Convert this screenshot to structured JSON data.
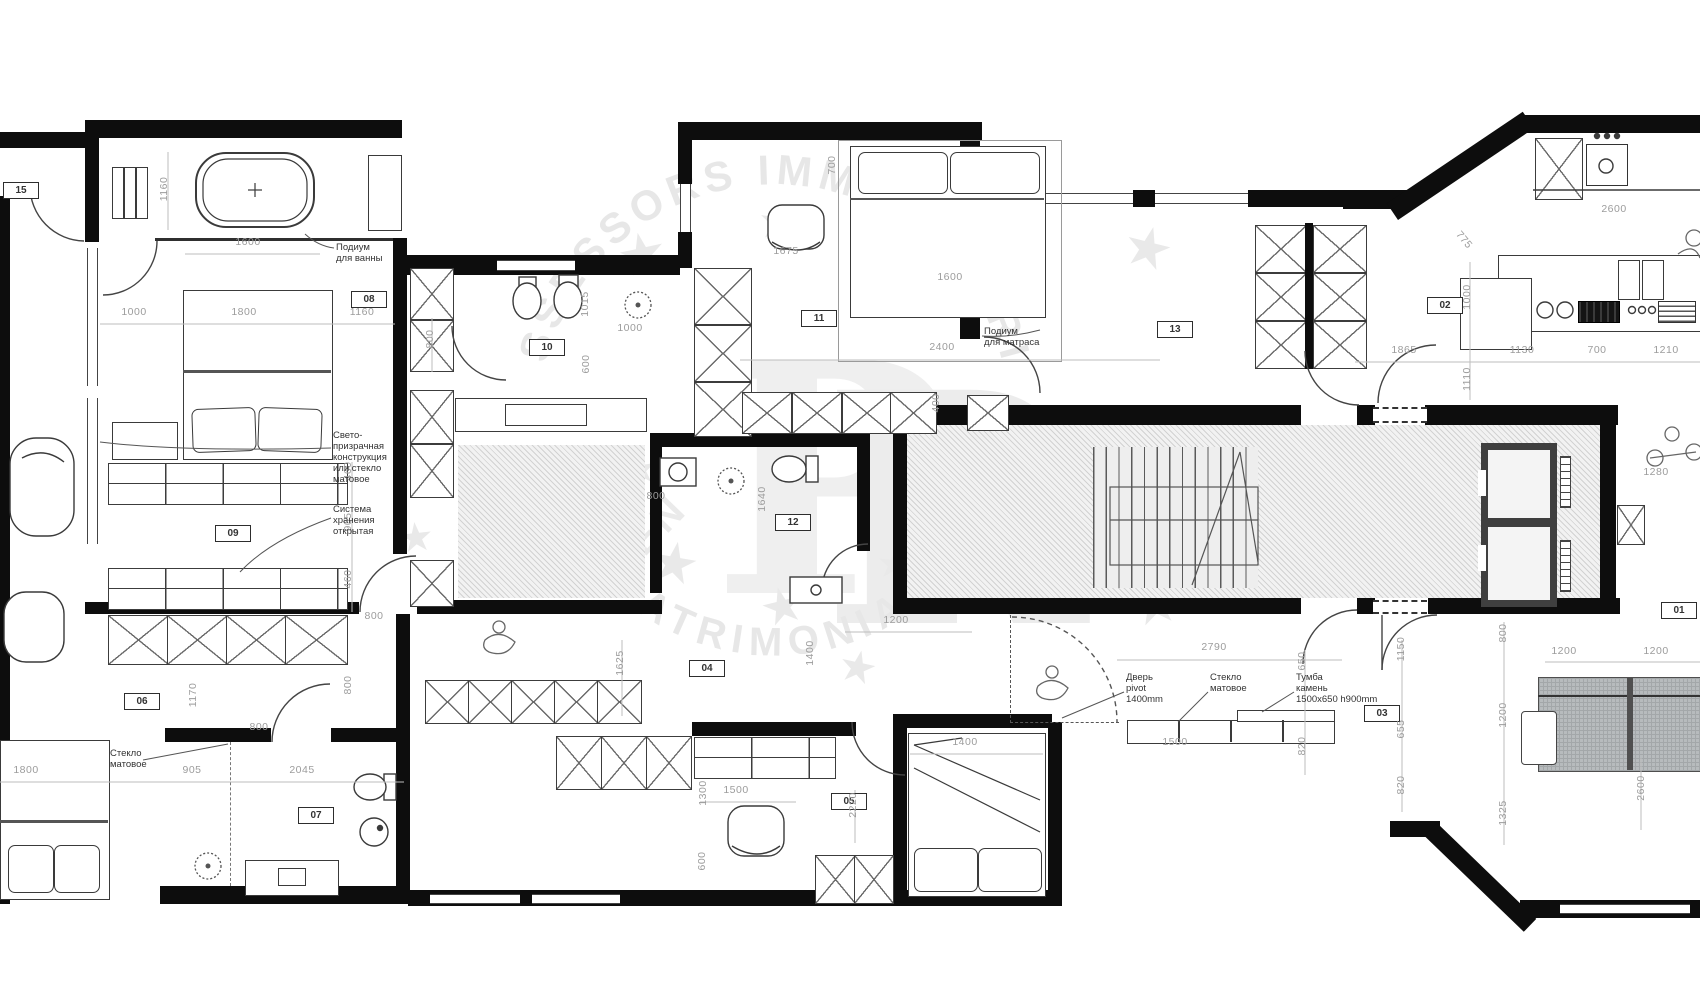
{
  "watermark": {
    "arc_top": "ASSESSORS IMMOBILIARIS",
    "arc_bottom": "PATRIMONIAL",
    "fragment": "MEN",
    "monogram_left": "P",
    "monogram_right": "R"
  },
  "rooms": [
    {
      "label": "15",
      "x": 20,
      "y": 190
    },
    {
      "label": "08",
      "x": 368,
      "y": 299
    },
    {
      "label": "09",
      "x": 232,
      "y": 533
    },
    {
      "label": "10",
      "x": 546,
      "y": 347
    },
    {
      "label": "11",
      "x": 818,
      "y": 318
    },
    {
      "label": "12",
      "x": 792,
      "y": 522
    },
    {
      "label": "13",
      "x": 1174,
      "y": 329
    },
    {
      "label": "02",
      "x": 1444,
      "y": 305
    },
    {
      "label": "01",
      "x": 1678,
      "y": 610
    },
    {
      "label": "03",
      "x": 1381,
      "y": 713
    },
    {
      "label": "04",
      "x": 706,
      "y": 668
    },
    {
      "label": "05",
      "x": 848,
      "y": 801
    },
    {
      "label": "06",
      "x": 141,
      "y": 701
    },
    {
      "label": "07",
      "x": 315,
      "y": 815
    }
  ],
  "dims": [
    {
      "t": "1160",
      "x": 164,
      "y": 190,
      "r": -90
    },
    {
      "t": "1600",
      "x": 248,
      "y": 243,
      "r": 0
    },
    {
      "t": "1000",
      "x": 134,
      "y": 313,
      "r": 0
    },
    {
      "t": "1800",
      "x": 244,
      "y": 313,
      "r": 0
    },
    {
      "t": "1160",
      "x": 362,
      "y": 313,
      "r": 0
    },
    {
      "t": "800",
      "x": 430,
      "y": 340,
      "r": -90
    },
    {
      "t": "460",
      "x": 348,
      "y": 472,
      "r": -90
    },
    {
      "t": "905",
      "x": 348,
      "y": 523,
      "r": -90
    },
    {
      "t": "460",
      "x": 348,
      "y": 580,
      "r": -90
    },
    {
      "t": "800",
      "x": 374,
      "y": 617,
      "r": 0
    },
    {
      "t": "700",
      "x": 832,
      "y": 166,
      "r": -90
    },
    {
      "t": "1675",
      "x": 786,
      "y": 252,
      "r": 0
    },
    {
      "t": "1600",
      "x": 950,
      "y": 278,
      "r": 0
    },
    {
      "t": "2400",
      "x": 942,
      "y": 348,
      "r": 0
    },
    {
      "t": "1000",
      "x": 630,
      "y": 329,
      "r": 0
    },
    {
      "t": "1015",
      "x": 585,
      "y": 305,
      "r": -90
    },
    {
      "t": "600",
      "x": 586,
      "y": 365,
      "r": -90
    },
    {
      "t": "800",
      "x": 656,
      "y": 497,
      "r": 0
    },
    {
      "t": "1640",
      "x": 762,
      "y": 500,
      "r": -90
    },
    {
      "t": "400",
      "x": 936,
      "y": 404,
      "r": -90
    },
    {
      "t": "2600",
      "x": 1614,
      "y": 210,
      "r": 0
    },
    {
      "t": "775",
      "x": 1464,
      "y": 241,
      "r": 50
    },
    {
      "t": "1000",
      "x": 1467,
      "y": 298,
      "r": -90
    },
    {
      "t": "1110",
      "x": 1467,
      "y": 380,
      "r": -90
    },
    {
      "t": "1865",
      "x": 1404,
      "y": 351,
      "r": 0
    },
    {
      "t": "1130",
      "x": 1522,
      "y": 351,
      "r": 0
    },
    {
      "t": "700",
      "x": 1597,
      "y": 351,
      "r": 0
    },
    {
      "t": "1210",
      "x": 1666,
      "y": 351,
      "r": 0
    },
    {
      "t": "1280",
      "x": 1656,
      "y": 473,
      "r": 0
    },
    {
      "t": "1200",
      "x": 896,
      "y": 621,
      "r": 0
    },
    {
      "t": "1625",
      "x": 620,
      "y": 664,
      "r": -90
    },
    {
      "t": "1400",
      "x": 810,
      "y": 654,
      "r": -90
    },
    {
      "t": "1400",
      "x": 965,
      "y": 743,
      "r": 0
    },
    {
      "t": "1500",
      "x": 736,
      "y": 791,
      "r": 0
    },
    {
      "t": "1300",
      "x": 703,
      "y": 794,
      "r": -90
    },
    {
      "t": "2220",
      "x": 853,
      "y": 806,
      "r": -90
    },
    {
      "t": "600",
      "x": 702,
      "y": 862,
      "r": -90
    },
    {
      "t": "1170",
      "x": 193,
      "y": 696,
      "r": -90
    },
    {
      "t": "800",
      "x": 259,
      "y": 728,
      "r": 0
    },
    {
      "t": "800",
      "x": 348,
      "y": 686,
      "r": -90
    },
    {
      "t": "1800",
      "x": 26,
      "y": 771,
      "r": 0
    },
    {
      "t": "905",
      "x": 192,
      "y": 771,
      "r": 0
    },
    {
      "t": "2045",
      "x": 302,
      "y": 771,
      "r": 0
    },
    {
      "t": "2790",
      "x": 1214,
      "y": 648,
      "r": 0
    },
    {
      "t": "1500",
      "x": 1175,
      "y": 743,
      "r": 0
    },
    {
      "t": "650",
      "x": 1302,
      "y": 662,
      "r": -90
    },
    {
      "t": "820",
      "x": 1302,
      "y": 747,
      "r": -90
    },
    {
      "t": "1150",
      "x": 1401,
      "y": 650,
      "r": -90
    },
    {
      "t": "655",
      "x": 1401,
      "y": 730,
      "r": -90
    },
    {
      "t": "820",
      "x": 1401,
      "y": 786,
      "r": -90
    },
    {
      "t": "800",
      "x": 1503,
      "y": 634,
      "r": -90
    },
    {
      "t": "1200",
      "x": 1564,
      "y": 652,
      "r": 0
    },
    {
      "t": "1200",
      "x": 1656,
      "y": 652,
      "r": 0
    },
    {
      "t": "1200",
      "x": 1503,
      "y": 716,
      "r": -90
    },
    {
      "t": "1325",
      "x": 1503,
      "y": 814,
      "r": -90
    },
    {
      "t": "2600",
      "x": 1641,
      "y": 789,
      "r": -90
    }
  ],
  "annotations": [
    {
      "text": "Подиум\nдля ванны",
      "x": 336,
      "y": 242
    },
    {
      "text": "Свето-\nпризрачная\nконструкция\nили стекло\nматовое",
      "x": 333,
      "y": 430
    },
    {
      "text": "Система\nхранения\nоткрытая",
      "x": 333,
      "y": 504
    },
    {
      "text": "Подиум\nдля матраса",
      "x": 984,
      "y": 326
    },
    {
      "text": "Дверь\npivot\n1400mm",
      "x": 1126,
      "y": 672
    },
    {
      "text": "Стекло\nматовое",
      "x": 1210,
      "y": 672
    },
    {
      "text": "Тумба\nкамень\n1500x650  h900mm",
      "x": 1296,
      "y": 672
    },
    {
      "text": "Стекло\nматовое",
      "x": 110,
      "y": 748
    }
  ],
  "stars": [
    {
      "t": "★",
      "x": 617,
      "y": 226,
      "s": 56,
      "r": -12
    },
    {
      "t": "★",
      "x": 757,
      "y": 200,
      "s": 48,
      "r": 8
    },
    {
      "t": "★",
      "x": 944,
      "y": 192,
      "s": 52,
      "r": -6
    },
    {
      "t": "★",
      "x": 1123,
      "y": 220,
      "s": 56,
      "r": 14
    },
    {
      "t": "★",
      "x": 874,
      "y": 282,
      "s": 34,
      "r": 0
    },
    {
      "t": "★",
      "x": 622,
      "y": 450,
      "s": 40,
      "r": -8
    },
    {
      "t": "★",
      "x": 649,
      "y": 535,
      "s": 56,
      "r": 10
    },
    {
      "t": "★",
      "x": 760,
      "y": 581,
      "s": 50,
      "r": -14
    },
    {
      "t": "★",
      "x": 876,
      "y": 545,
      "s": 40,
      "r": 6
    },
    {
      "t": "★",
      "x": 1130,
      "y": 576,
      "s": 56,
      "r": -10
    },
    {
      "t": "★",
      "x": 1023,
      "y": 555,
      "s": 36,
      "r": 0
    },
    {
      "t": "★",
      "x": 838,
      "y": 646,
      "s": 44,
      "r": 12
    },
    {
      "t": "★",
      "x": 398,
      "y": 518,
      "s": 40,
      "r": -6
    }
  ]
}
